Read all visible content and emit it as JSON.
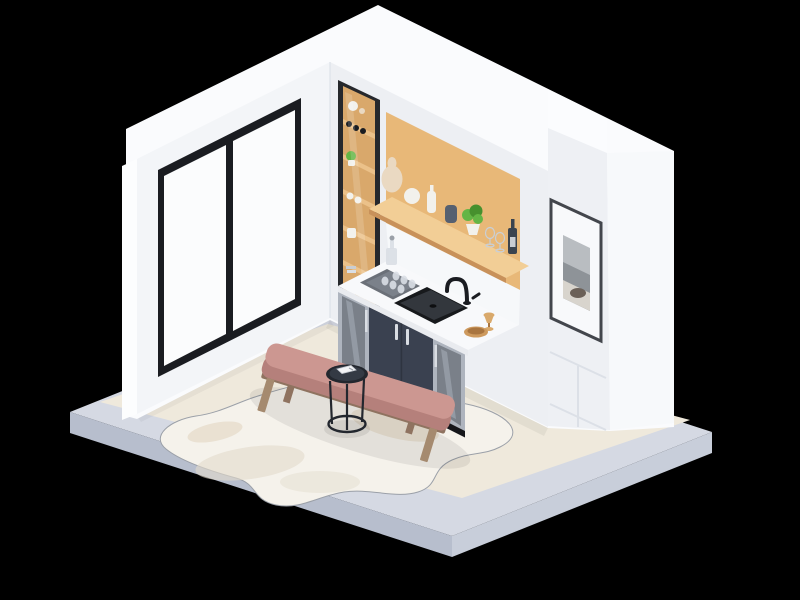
{
  "scene": {
    "type": "isometric-3d-room-render",
    "room": "mini bar / kitchenette nook with lounge bench",
    "background": "black",
    "objects": [
      {
        "name": "platform-base",
        "description": "blue-gray plinth slab under cream floor"
      },
      {
        "name": "sliding-glass-door",
        "description": "black framed two-pane sliding door on left wall"
      },
      {
        "name": "tall-shelf-cabinet",
        "description": "black framed wooden shelving unit with vases, wine bottles, plant"
      },
      {
        "name": "wood-niche",
        "description": "oak back panel recess behind bar counter"
      },
      {
        "name": "floating-shelf",
        "description": "oak shelf with vases, plant, wine glasses and wine bottle"
      },
      {
        "name": "serving-tray",
        "description": "gray tray with decanter and six glasses"
      },
      {
        "name": "sink",
        "description": "black undermount bar sink with black gooseneck faucet"
      },
      {
        "name": "beverage-fridges",
        "description": "two glass-door coolers flanking navy cabinet doors"
      },
      {
        "name": "cabinet-doors",
        "description": "dark navy double doors with chrome handles"
      },
      {
        "name": "wood-bowl",
        "description": "small wooden bowl and goblet on counter"
      },
      {
        "name": "framed-photo",
        "description": "black framed grayscale coastal photograph on white column"
      },
      {
        "name": "bench",
        "description": "wood frame bench with dusty-rose cushion"
      },
      {
        "name": "side-table",
        "description": "round black wire drink table with small white book"
      },
      {
        "name": "cowhide-rug",
        "description": "irregular cream cowhide rug"
      }
    ]
  },
  "palette": {
    "bg": "#000000",
    "plinthTop": "#D5D9E3",
    "plinthLeft": "#B7BECD",
    "plinthRight": "#C8CEDA",
    "floor": "#EFE9DC",
    "rug": "#F5F2EB",
    "rugPatch": "#E3DBCB",
    "rugPatchWarm": "#DFD0B9",
    "rugLine": "#9BA0A8",
    "shellWhite": "#FAFBFD",
    "wallLeft": "#F3F5F8",
    "wallLeftEdge": "#FCFDFE",
    "wallBack": "#EDEFF3",
    "backsplash": "#F6F8FA",
    "column": "#EEF0F4",
    "columnSide": "#F7F9FB",
    "columnTop": "#FBFCFE",
    "frameBlack": "#1A1C21",
    "glassWhite": "#FBFCFD",
    "woodPanel": "#E8B878",
    "woodShelfTop": "#F2CE96",
    "woodShelfEdge": "#C8915A",
    "woodUnitBack": "#D9A86B",
    "woodShelfLight": "#EBC189",
    "unitFrame": "#26282C",
    "counterTop": "#F8F9FB",
    "counterEdge": "#E9EBEF",
    "cabinetNavy": "#3A4150",
    "cabinetNavyDark": "#2E3440",
    "steel": "#AEB4BE",
    "steelLight": "#D9DDE3",
    "fridgeGlass": "#7A8089",
    "fridgeStreak": "#A8AFB9",
    "toeKick": "#15161A",
    "sinkRim": "#17191C",
    "sinkBasin": "#33373D",
    "trayGray": "#6B7078",
    "trayInner": "#7B818A",
    "glassItem": "#D9DEE4",
    "pictureFrame": "#43464C",
    "pictureMat": "#F8F9FB",
    "photoSky": "#B9BDC1",
    "photoSea": "#8E9398",
    "photoSand": "#D8D4CD",
    "photoRock": "#6B6058",
    "benchPink": "#CC9791",
    "benchPinkSide": "#B5807B",
    "benchRail": "#8F7360",
    "benchLeg": "#A58A6F",
    "tableBlack": "#23272E",
    "tableTopInner": "#343A44",
    "plantGreen": "#64B545",
    "plantGreenDark": "#47902E",
    "vaseCream": "#EAD9C2",
    "vaseWhite": "#F2F1EC",
    "vaseDark": "#566070",
    "bottleDark": "#3A434E",
    "labelGray": "#C9CDD2",
    "bowlWood": "#CE9A5E",
    "bowlInner": "#A9753F",
    "goblet": "#D9A96B",
    "bookWhite": "#F3F4F6",
    "groove": "#DCE0E7",
    "shadow": "#000000"
  }
}
